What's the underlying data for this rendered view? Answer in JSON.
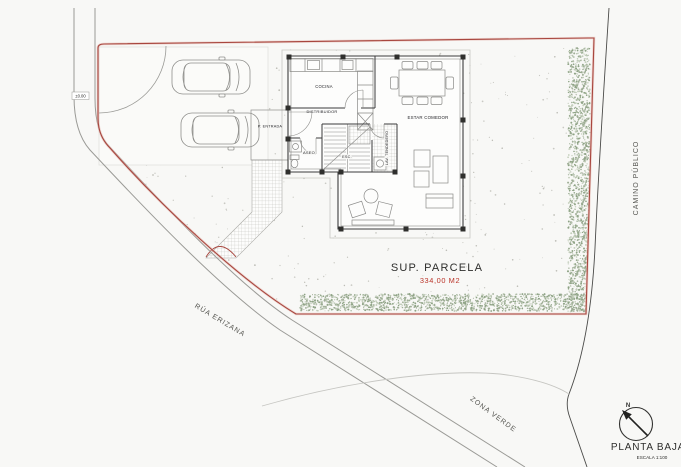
{
  "drawing": {
    "title": "PLANTA BAJA",
    "scale": "ESCALA 1:100",
    "north": "N"
  },
  "parcel": {
    "surface_label": "SUP. PARCELA",
    "surface_value": "334,00 M2",
    "level_marker": "±0.00"
  },
  "streets": {
    "west": "RÚA ERIZANA",
    "east": "CAMINO PÚBLICO",
    "south_area": "ZONA VERDE"
  },
  "rooms": {
    "kitchen": "COCINA",
    "hall": "DISTRIBUIDOR",
    "living_dining": "ESTAR COMEDOR",
    "toilet": "ASEO",
    "stairs": "ESC.",
    "laundry": "LAV. TENDEDERO",
    "entry_porch": "P. ENTRADA"
  },
  "colors": {
    "paper": "#f8f8f6",
    "boundary": "#a8463e",
    "area_text": "#bb3429",
    "wall": "#3c3c3c",
    "vegetation": "#9fae96"
  }
}
